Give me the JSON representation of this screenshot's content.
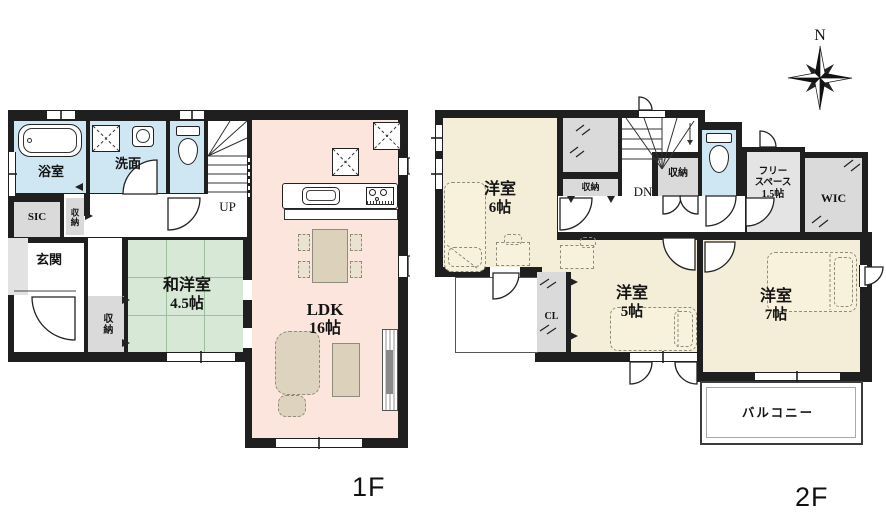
{
  "compass": {
    "north_label": "N"
  },
  "colors": {
    "wall": "#1f1f1f",
    "water_rooms": "#cfe7f3",
    "tatami_room": "#d7e9d6",
    "ldk": "#fbe5dd",
    "bedroom": "#f4eed8",
    "closet_gray": "#dadada",
    "furniture": "#dcd1bb"
  },
  "floor1": {
    "floor_label": "1F",
    "rooms": {
      "bath": {
        "label": "浴室"
      },
      "washroom": {
        "label": "洗面"
      },
      "sic": {
        "label": "SIC"
      },
      "hall_storage": {
        "label": "収納"
      },
      "entrance": {
        "label": "玄関"
      },
      "lower_storage": {
        "label": "収納"
      },
      "japanese_room": {
        "label": "和洋室",
        "size": "4.5帖"
      },
      "ldk": {
        "label": "LDK",
        "size": "16帖"
      },
      "stairs": {
        "label": "UP"
      }
    }
  },
  "floor2": {
    "floor_label": "2F",
    "rooms": {
      "bedroom6": {
        "label": "洋室",
        "size": "6帖"
      },
      "top_closet": {
        "label": "収納"
      },
      "stairs": {
        "label": "DN"
      },
      "stair_storage": {
        "label": "収納"
      },
      "free_space": {
        "label_line1": "フリー",
        "label_line2": "スペース",
        "size": "1.5帖"
      },
      "wic": {
        "label": "WIC"
      },
      "closet": {
        "label": "CL"
      },
      "bedroom5": {
        "label": "洋室",
        "size": "5帖"
      },
      "bedroom7": {
        "label": "洋室",
        "size": "7帖"
      },
      "balcony": {
        "label": "バルコニー"
      }
    }
  }
}
